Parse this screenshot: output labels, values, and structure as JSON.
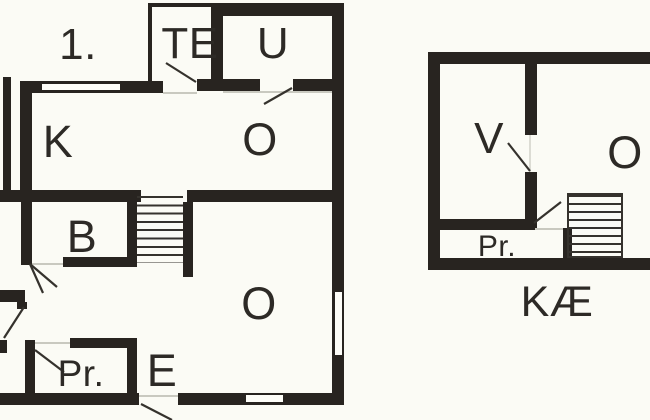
{
  "document": {
    "type": "floor-plan",
    "colors": {
      "wall": "#282420",
      "background": "#fbfbf5",
      "door_line": "#35322d",
      "threshold_line": "#c9c9c0",
      "text": "#2d2a26"
    }
  },
  "floor1": {
    "title": "1.",
    "rooms": {
      "te": "TE",
      "u": "U",
      "k": "K",
      "o_top": "O",
      "b": "B",
      "o_main": "O",
      "pr": "Pr.",
      "e": "E"
    }
  },
  "basement": {
    "title": "KÆ",
    "rooms": {
      "v": "V",
      "o": "O",
      "pr": "Pr."
    }
  }
}
